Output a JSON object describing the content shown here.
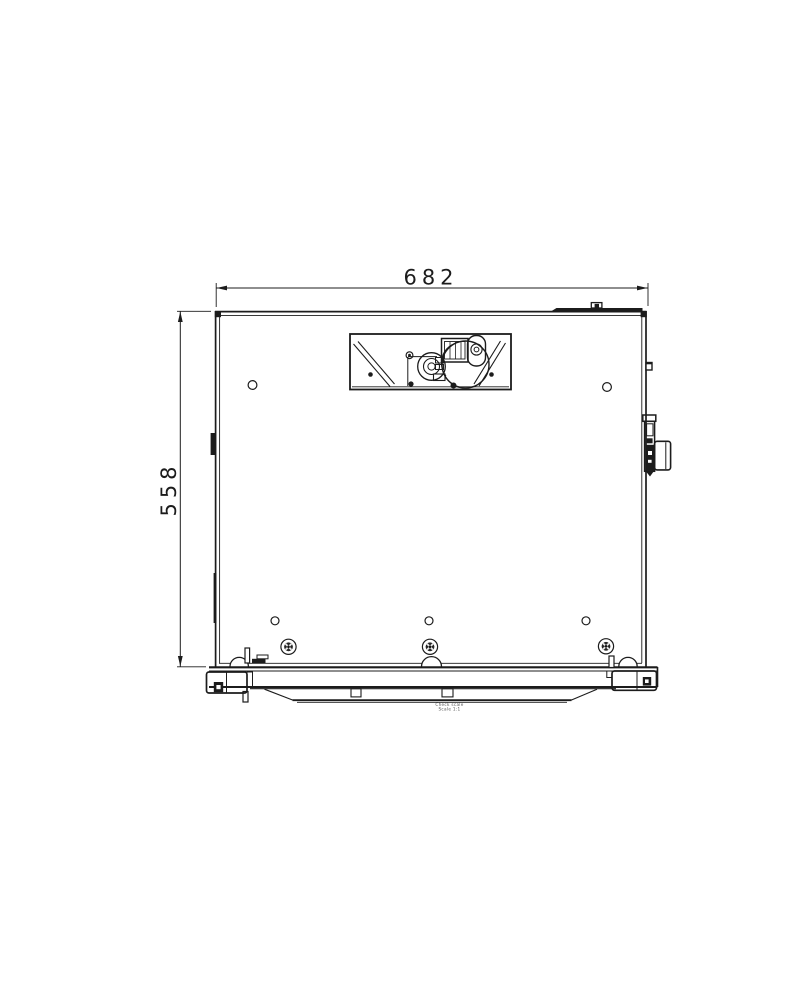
{
  "drawing": {
    "horizontal_dimension": "682",
    "vertical_dimension": "558",
    "stamp_line1": "Check scale",
    "stamp_line2": "Scale 1:1",
    "colors": {
      "line": "#1c1c1c",
      "background": "#ffffff"
    }
  }
}
